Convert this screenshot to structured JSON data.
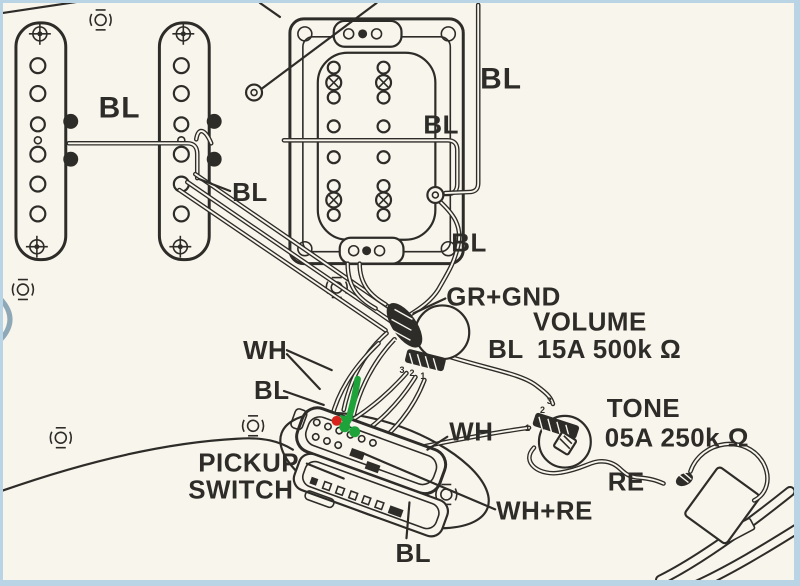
{
  "diagram_type": "guitar-pickup-wiring-diagram",
  "colors": {
    "background": "#f8f5ec",
    "ink": "#2e2c28",
    "border": "#b9d5e5",
    "annotation_green": "#1ea23a",
    "annotation_red": "#d8231c"
  },
  "labels": {
    "neck_pickup_wire": "BL",
    "middle_pickup_wire": "BL",
    "bridge_top_wire": "BL",
    "bridge_mid_wire": "BL",
    "bridge_out_wire": "BL",
    "ground": "GR+GND",
    "volume_title": "VOLUME",
    "volume_wire": "BL",
    "volume_value": "15A 500k Ω",
    "switch_white_wires": "WH",
    "switch_black_wire": "BL",
    "pickup_switch_line1": "PICKUP",
    "pickup_switch_line2": "SWITCH",
    "tone_white_wire": "WH",
    "tone_title": "TONE",
    "tone_value": "05A 250k Ω",
    "jack_red_wire": "RE",
    "switch_white_red_wire": "WH+RE",
    "switch_bottom_wire": "BL"
  },
  "lugs": {
    "volume": [
      "3",
      "2",
      "1"
    ],
    "tone": [
      "3",
      "2",
      "1"
    ]
  },
  "annotations": {
    "green_arrow": "down-arrow-to-switch-terminal",
    "green_dots": "2 dots on switch terminals",
    "red_dot": "1 dot on switch terminal"
  }
}
